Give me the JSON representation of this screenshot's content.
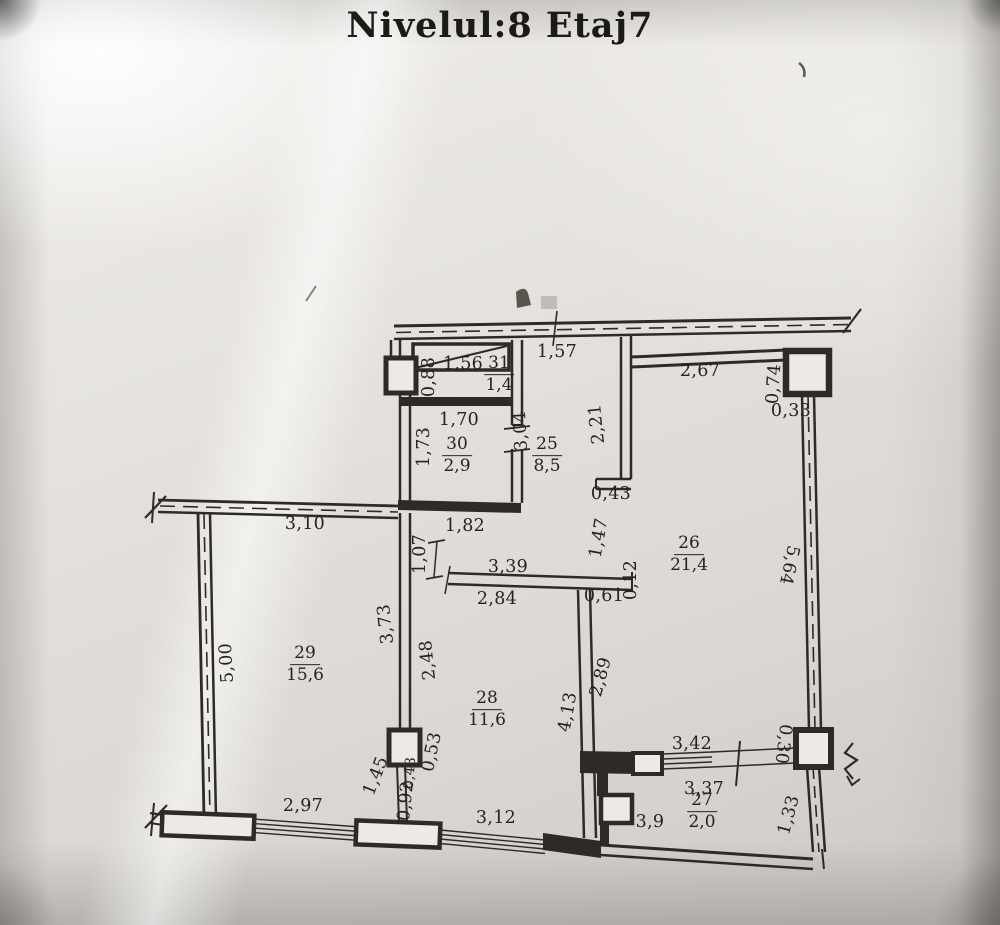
{
  "title": "Nivelul:8 Etaj7",
  "colors": {
    "paper": "#e5e2dd",
    "ink": "#2e2b27",
    "text": "#26231f"
  },
  "plan": {
    "room_labels": [
      {
        "num": "31",
        "area": "1,4",
        "x": 499,
        "y": 375
      },
      {
        "num": "30",
        "area": "2,9",
        "x": 457,
        "y": 456
      },
      {
        "num": "25",
        "area": "8,5",
        "x": 547,
        "y": 456
      },
      {
        "num": "26",
        "area": "21,4",
        "x": 689,
        "y": 555
      },
      {
        "num": "29",
        "area": "15,6",
        "x": 305,
        "y": 665
      },
      {
        "num": "28",
        "area": "11,6",
        "x": 487,
        "y": 710
      },
      {
        "num": "27",
        "area": "2,0",
        "x": 702,
        "y": 812
      }
    ],
    "dim_labels": [
      {
        "text": "1,57",
        "x": 557,
        "y": 352
      },
      {
        "text": "2,67",
        "x": 700,
        "y": 371
      },
      {
        "text": "0,74",
        "x": 774,
        "y": 384,
        "rot": -86
      },
      {
        "text": "0,33",
        "x": 791,
        "y": 411
      },
      {
        "text": "0,88",
        "x": 429,
        "y": 377,
        "rot": -90
      },
      {
        "text": "1,56",
        "x": 463,
        "y": 364
      },
      {
        "text": "1,70",
        "x": 459,
        "y": 420
      },
      {
        "text": "1,73",
        "x": 424,
        "y": 447,
        "rot": -90
      },
      {
        "text": "3,04",
        "x": 521,
        "y": 431,
        "rot": -93
      },
      {
        "text": "2,21",
        "x": 597,
        "y": 424,
        "rot": -96
      },
      {
        "text": "0,43",
        "x": 611,
        "y": 494
      },
      {
        "text": "3,10",
        "x": 305,
        "y": 524
      },
      {
        "text": "1,82",
        "x": 465,
        "y": 526
      },
      {
        "text": "1,07",
        "x": 420,
        "y": 554,
        "rot": -90
      },
      {
        "text": "1,47",
        "x": 599,
        "y": 538,
        "rot": -80
      },
      {
        "text": "3,39",
        "x": 508,
        "y": 567
      },
      {
        "text": "2,84",
        "x": 497,
        "y": 599
      },
      {
        "text": "0,61",
        "x": 604,
        "y": 596
      },
      {
        "text": "0,12",
        "x": 631,
        "y": 580,
        "rot": -90
      },
      {
        "text": "5,64",
        "x": 789,
        "y": 565,
        "rot": 102
      },
      {
        "text": "3,73",
        "x": 386,
        "y": 624,
        "rot": -96
      },
      {
        "text": "2,48",
        "x": 428,
        "y": 660,
        "rot": -96
      },
      {
        "text": "5,00",
        "x": 227,
        "y": 663,
        "rot": -93
      },
      {
        "text": "2,89",
        "x": 601,
        "y": 677,
        "rot": -75
      },
      {
        "text": "4,13",
        "x": 568,
        "y": 712,
        "rot": -80
      },
      {
        "text": "0,53",
        "x": 432,
        "y": 752,
        "rot": -78
      },
      {
        "text": "1,45",
        "x": 376,
        "y": 776,
        "rot": -68
      },
      {
        "text": "0,43",
        "x": 410,
        "y": 773,
        "rot": -85,
        "size": 14
      },
      {
        "text": "0,92",
        "x": 406,
        "y": 801,
        "rot": -84
      },
      {
        "text": "2,97",
        "x": 303,
        "y": 806
      },
      {
        "text": "3,12",
        "x": 496,
        "y": 818
      },
      {
        "text": "3,42",
        "x": 692,
        "y": 744
      },
      {
        "text": "0,30",
        "x": 783,
        "y": 744,
        "rot": 97
      },
      {
        "text": "3,37",
        "x": 704,
        "y": 789
      },
      {
        "text": "3,9",
        "x": 650,
        "y": 822
      },
      {
        "text": "1,33",
        "x": 789,
        "y": 815,
        "rot": -75
      }
    ]
  }
}
